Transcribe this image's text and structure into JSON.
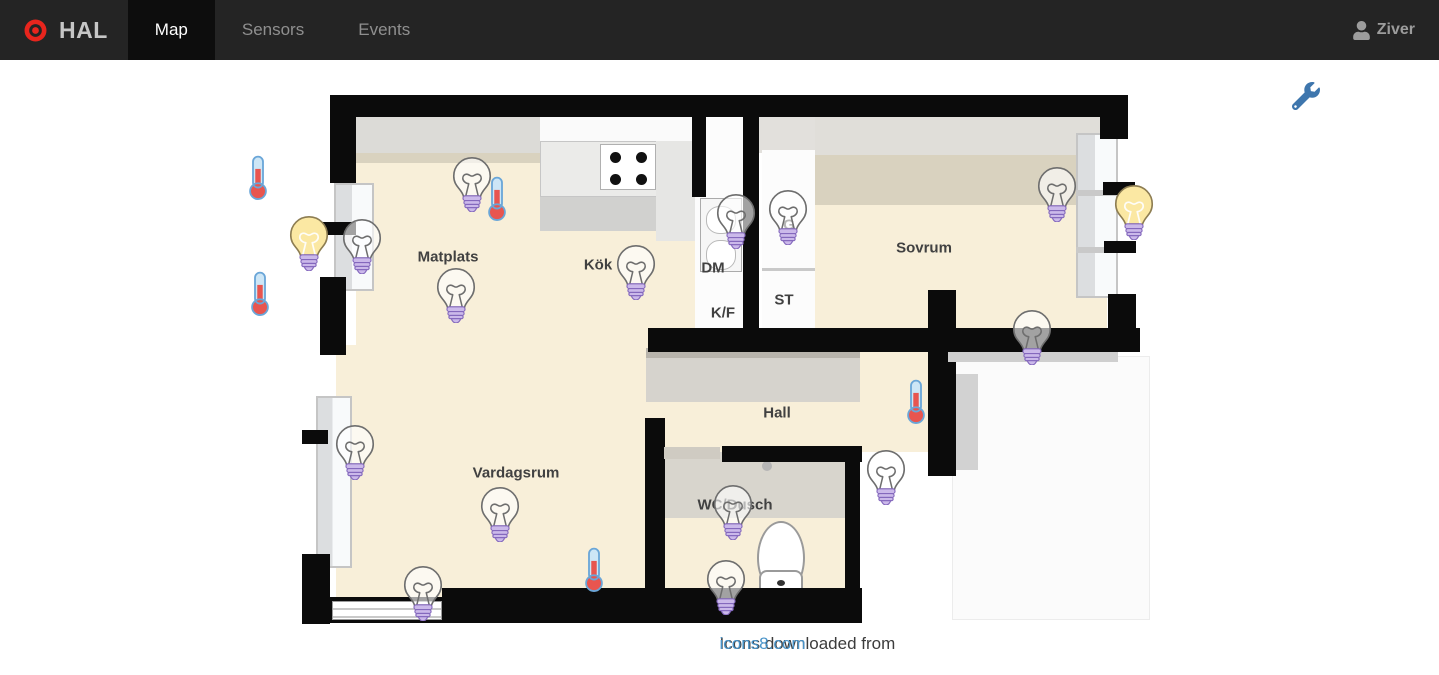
{
  "navbar": {
    "brand": "HAL",
    "logo_icon": "target-record-icon",
    "tabs": [
      {
        "label": "Map",
        "active": true
      },
      {
        "label": "Sensors",
        "active": false
      },
      {
        "label": "Events",
        "active": false
      }
    ],
    "user": {
      "name": "Ziver",
      "icon": "user-icon"
    }
  },
  "map": {
    "settings_icon": "wrench-icon",
    "rooms": [
      {
        "name": "Matplats",
        "x": 448,
        "y": 257
      },
      {
        "name": "Kök",
        "x": 598,
        "y": 265
      },
      {
        "name": "DM",
        "x": 713,
        "y": 268
      },
      {
        "name": "K/F",
        "x": 723,
        "y": 313
      },
      {
        "name": "G",
        "x": 789,
        "y": 225
      },
      {
        "name": "ST",
        "x": 784,
        "y": 300
      },
      {
        "name": "Sovrum",
        "x": 924,
        "y": 248
      },
      {
        "name": "Hall",
        "x": 777,
        "y": 413
      },
      {
        "name": "Vardagsrum",
        "x": 516,
        "y": 473
      },
      {
        "name": "WC/Dusch",
        "x": 735,
        "y": 505
      }
    ],
    "sensors": [
      {
        "type": "thermometer",
        "x": 258,
        "y": 178
      },
      {
        "type": "thermometer",
        "x": 260,
        "y": 294
      },
      {
        "type": "thermometer",
        "x": 497,
        "y": 199
      },
      {
        "type": "thermometer",
        "x": 916,
        "y": 402
      },
      {
        "type": "thermometer",
        "x": 594,
        "y": 570
      },
      {
        "type": "light-on",
        "x": 309,
        "y": 242
      },
      {
        "type": "light-on",
        "x": 1134,
        "y": 211
      },
      {
        "type": "light-off",
        "x": 472,
        "y": 183
      },
      {
        "type": "light-off",
        "x": 362,
        "y": 245
      },
      {
        "type": "light-off",
        "x": 456,
        "y": 294
      },
      {
        "type": "light-off",
        "x": 636,
        "y": 271
      },
      {
        "type": "light-off",
        "x": 736,
        "y": 220
      },
      {
        "type": "light-off",
        "x": 788,
        "y": 216
      },
      {
        "type": "light-off",
        "x": 1057,
        "y": 193
      },
      {
        "type": "light-off",
        "x": 1032,
        "y": 336
      },
      {
        "type": "light-off",
        "x": 355,
        "y": 451
      },
      {
        "type": "light-off",
        "x": 500,
        "y": 513
      },
      {
        "type": "light-off",
        "x": 423,
        "y": 592
      },
      {
        "type": "light-off",
        "x": 886,
        "y": 476
      },
      {
        "type": "light-off",
        "x": 733,
        "y": 511
      },
      {
        "type": "light-off",
        "x": 726,
        "y": 586
      }
    ]
  },
  "footer": {
    "text": "Icons downloaded from",
    "link": "icons8.com"
  },
  "colors": {
    "brand_red": "#e8251d",
    "wrench_blue": "#3e76ad",
    "link_blue": "#4a94c9",
    "bulb_on_yellow": "#fbe8a3",
    "bulb_base_purple": "#cbb9ea",
    "thermo_red": "#e8554f",
    "floor_beige": "#f8efd9",
    "wall_black": "#0b0b0b"
  }
}
